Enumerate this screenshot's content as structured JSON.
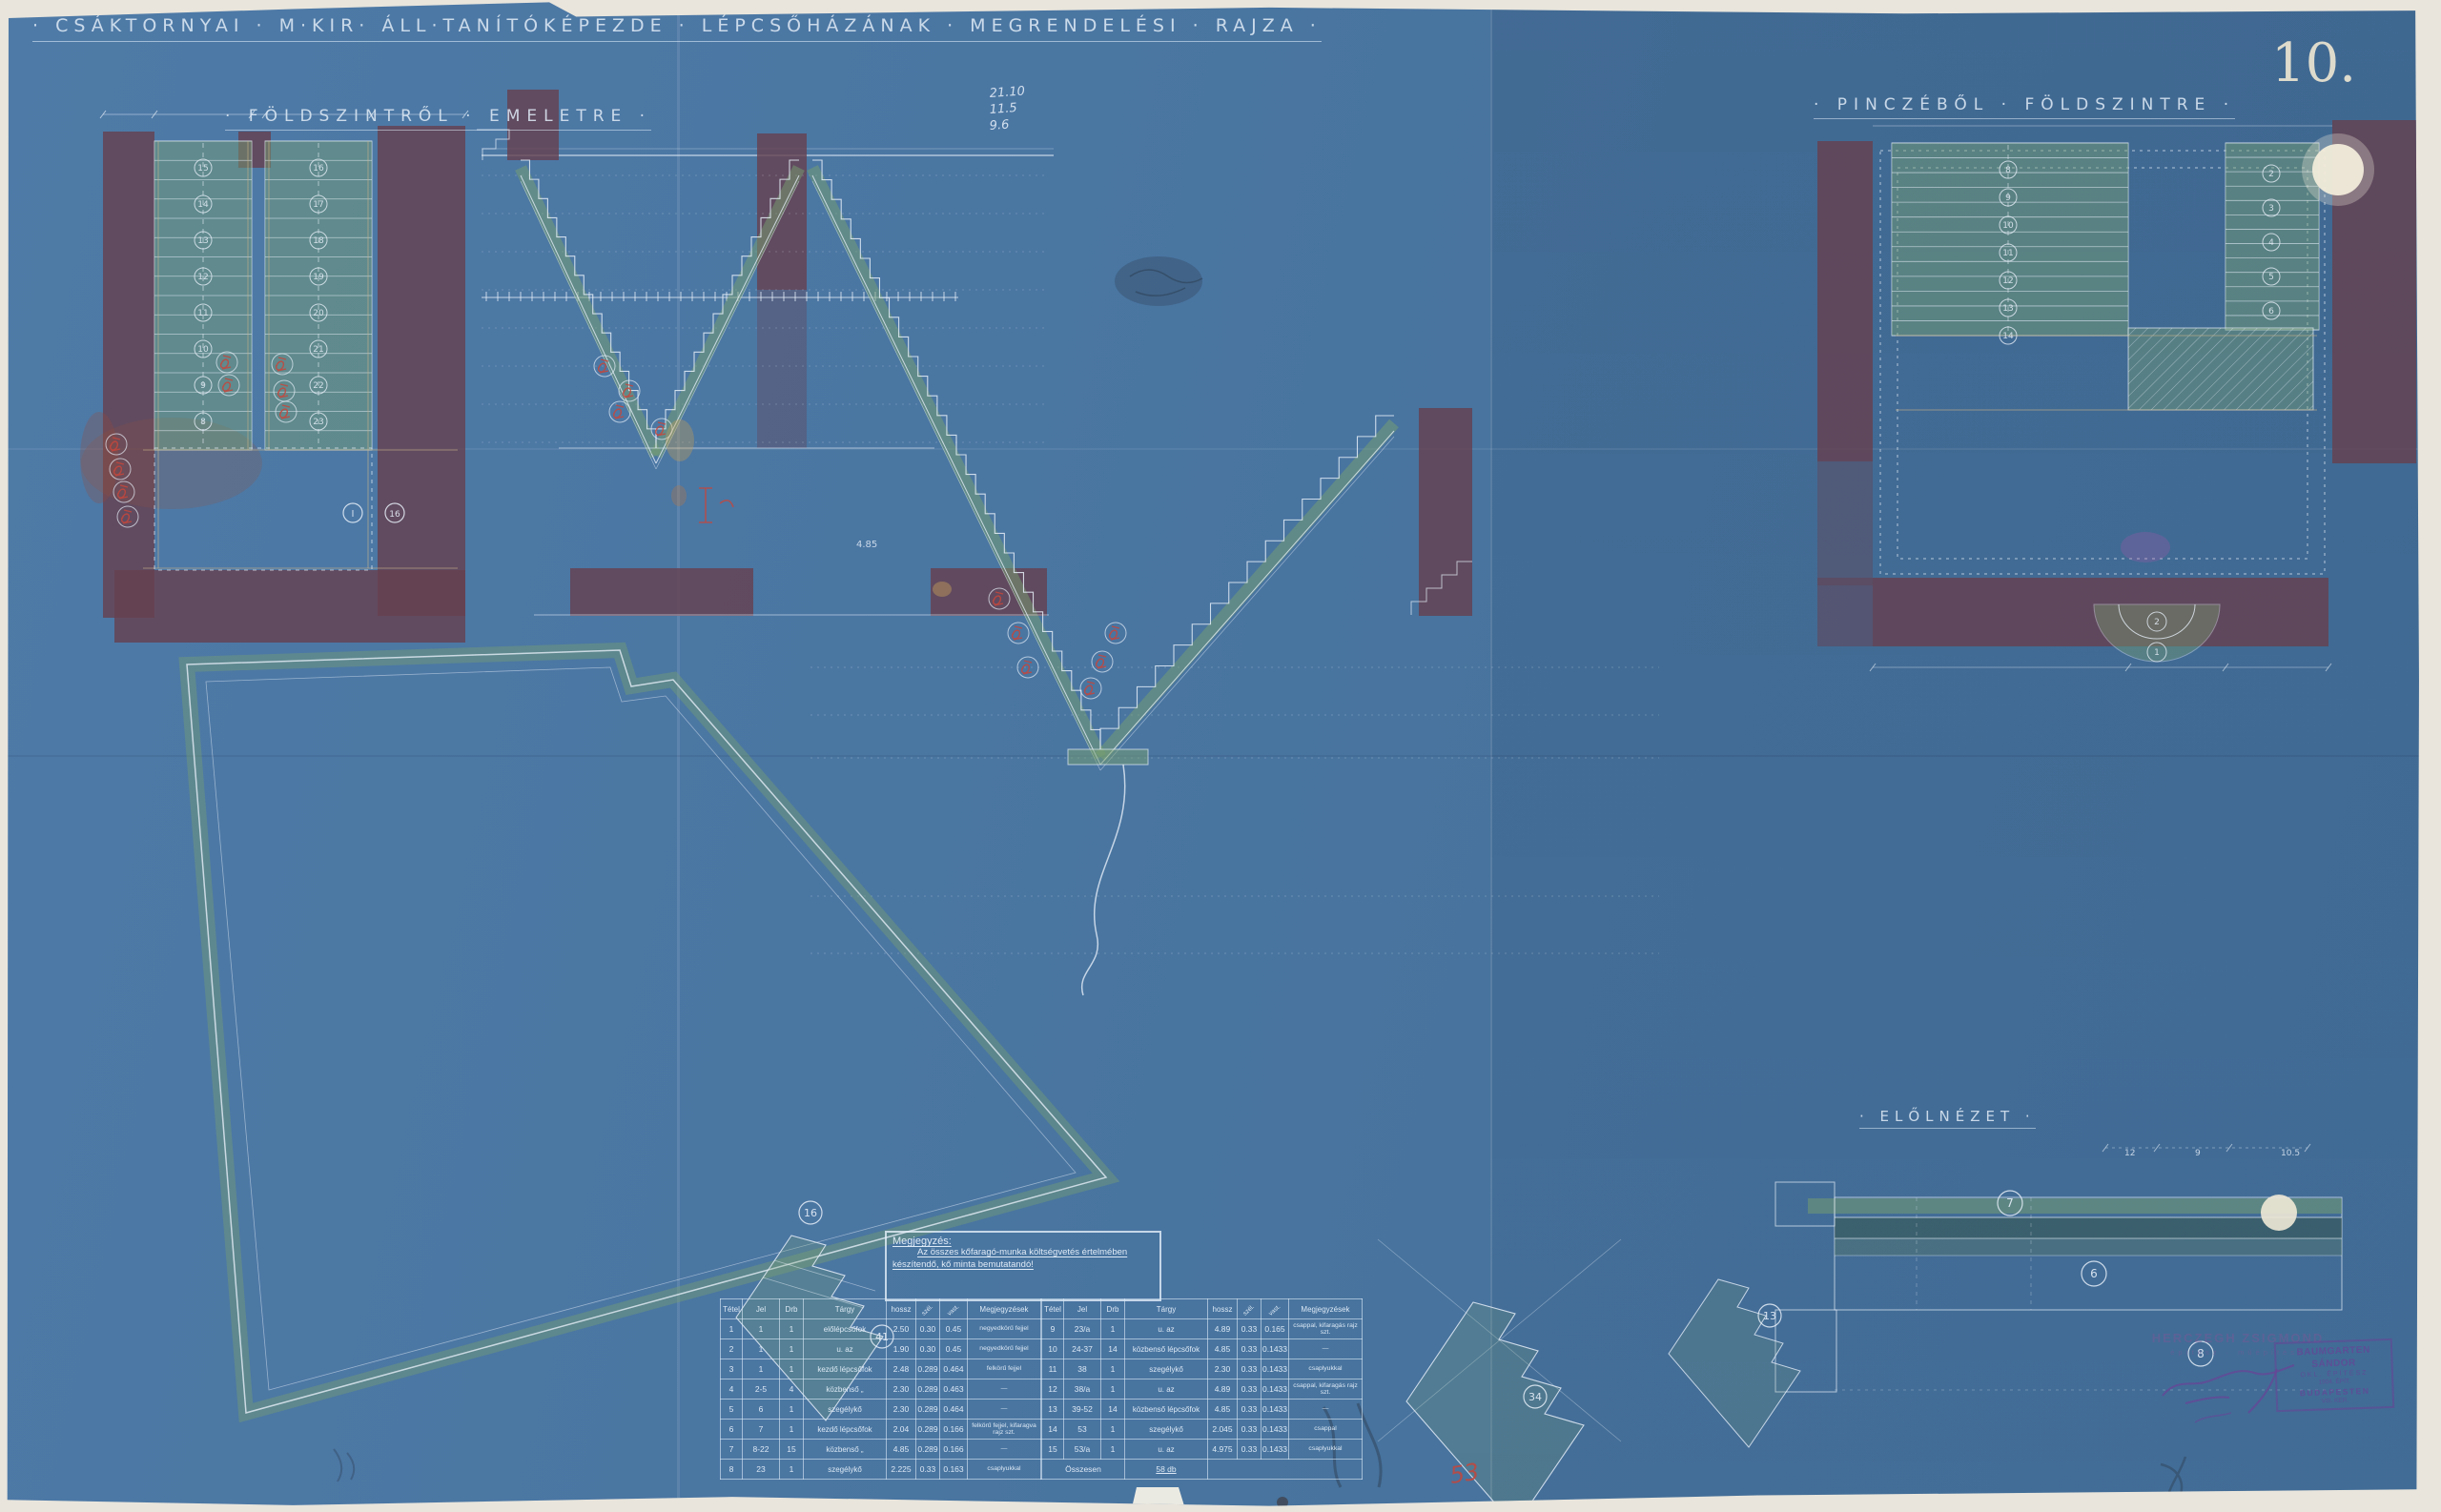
{
  "sheet": {
    "title": "· CSÁKTORNYAI · M·KIR· ÁLL·TANÍTÓKÉPEZDE · LÉPCSŐHÁZÁNAK · MEGRENDELÉSI · RAJZA ·",
    "subtitle_left": "· FÖLDSZINTRŐL · EMELETRE ·",
    "subtitle_right": "· PINCZÉBŐL · FÖLDSZINTRE ·",
    "number": "10.",
    "paper_color": "#4a76a2",
    "line_color": "#e6eef8",
    "wall_color": "#66404f",
    "tread_color": "#78a070",
    "ochre_color": "#c9b489",
    "red_mark_color": "#c4473c",
    "stamp_color": "#7a57a8"
  },
  "labels": {
    "front_view": "· ELŐLNÉZET ·"
  },
  "note": {
    "title": "Megjegyzés:",
    "line1": "Az összes kőfaragó-munka költségvetés értelmében",
    "line2": "készítendő, kő minta bemutatandó!"
  },
  "table": {
    "headers": [
      "Tétel",
      "Jel",
      "Drb",
      "Tárgy",
      "hossz",
      "szél.",
      "vast.",
      "Megjegyzések"
    ],
    "left_rows": [
      [
        "1",
        "1",
        "1",
        "előlépcsőfok",
        "2.50",
        "0.30",
        "0.45",
        "negyedkörű fejjel"
      ],
      [
        "2",
        "1",
        "1",
        "u. az",
        "1.90",
        "0.30",
        "0.45",
        "negyedkörű fejjel"
      ],
      [
        "3",
        "1",
        "1",
        "kezdő lépcsőfok",
        "2.48",
        "0.289",
        "0.464",
        "felkörű fejjel"
      ],
      [
        "4",
        "2-5",
        "4",
        "közbenső  „",
        "2.30",
        "0.289",
        "0.463",
        "—"
      ],
      [
        "5",
        "6",
        "1",
        "szegélykő",
        "2.30",
        "0.289",
        "0.464",
        "—"
      ],
      [
        "6",
        "7",
        "1",
        "kezdő lépcsőfok",
        "2.04",
        "0.289",
        "0.166",
        "felkörű fejjel, kifaragva rajz szt."
      ],
      [
        "7",
        "8-22",
        "15",
        "közbenső  „",
        "4.85",
        "0.289",
        "0.166",
        "—"
      ],
      [
        "8",
        "23",
        "1",
        "szegélykő",
        "2.225",
        "0.33",
        "0.163",
        "csaplyukkal"
      ]
    ],
    "right_rows": [
      [
        "9",
        "23/a",
        "1",
        "u. az",
        "4.89",
        "0.33",
        "0.165",
        "csappal, kifaragás rajz szt."
      ],
      [
        "10",
        "24-37",
        "14",
        "közbenső lépcsőfok",
        "4.85",
        "0.33",
        "0.1433",
        "—"
      ],
      [
        "11",
        "38",
        "1",
        "szegélykő",
        "2.30",
        "0.33",
        "0.1433",
        "csaplyukkal"
      ],
      [
        "12",
        "38/a",
        "1",
        "u. az",
        "4.89",
        "0.33",
        "0.1433",
        "csappal, kifaragás rajz szt."
      ],
      [
        "13",
        "39-52",
        "14",
        "közbenső lépcsőfok",
        "4.85",
        "0.33",
        "0.1433",
        "—"
      ],
      [
        "14",
        "53",
        "1",
        "szegélykő",
        "2.045",
        "0.33",
        "0.1433",
        "csappal"
      ],
      [
        "15",
        "53/a",
        "1",
        "u. az",
        "4.975",
        "0.33",
        "0.1433",
        "csaplyukkal"
      ]
    ],
    "total_label": "Összesen",
    "total_value": "58 db"
  },
  "annotations": {
    "handwritten": [
      "21.10",
      "11.5",
      "9.6"
    ],
    "red_item": "53",
    "section_dim": "4.85",
    "front_dims": [
      "12",
      "9",
      "10.5"
    ]
  },
  "step_numbers": {
    "left_plan_flight_a": [
      "15",
      "14",
      "13",
      "12",
      "11",
      "10",
      "9",
      "8"
    ],
    "left_plan_flight_b": [
      "16",
      "17",
      "18",
      "19",
      "20",
      "21",
      "22",
      "23"
    ],
    "right_plan_flight_top": [
      "8",
      "9",
      "10",
      "11",
      "12",
      "13",
      "14"
    ],
    "right_plan_flight_right": [
      "2",
      "3",
      "4",
      "5",
      "6"
    ],
    "right_plan_winders": [
      "2",
      "1"
    ],
    "front_view": [
      "7",
      "6",
      "8"
    ],
    "sketch_details": [
      "16",
      "41",
      "34",
      "13"
    ]
  },
  "stamps": {
    "architect_firm": "HERCZEGH ZSIGMOND",
    "architect_firm_sub": "építész · műépítész",
    "box_lines": [
      "BAUMGARTEN SÁNDOR",
      "OKL. ÉPÍTÉSZ",
      "1904. ÉPÍT.",
      "BUDAPESTEN",
      "VIII. KER."
    ]
  }
}
